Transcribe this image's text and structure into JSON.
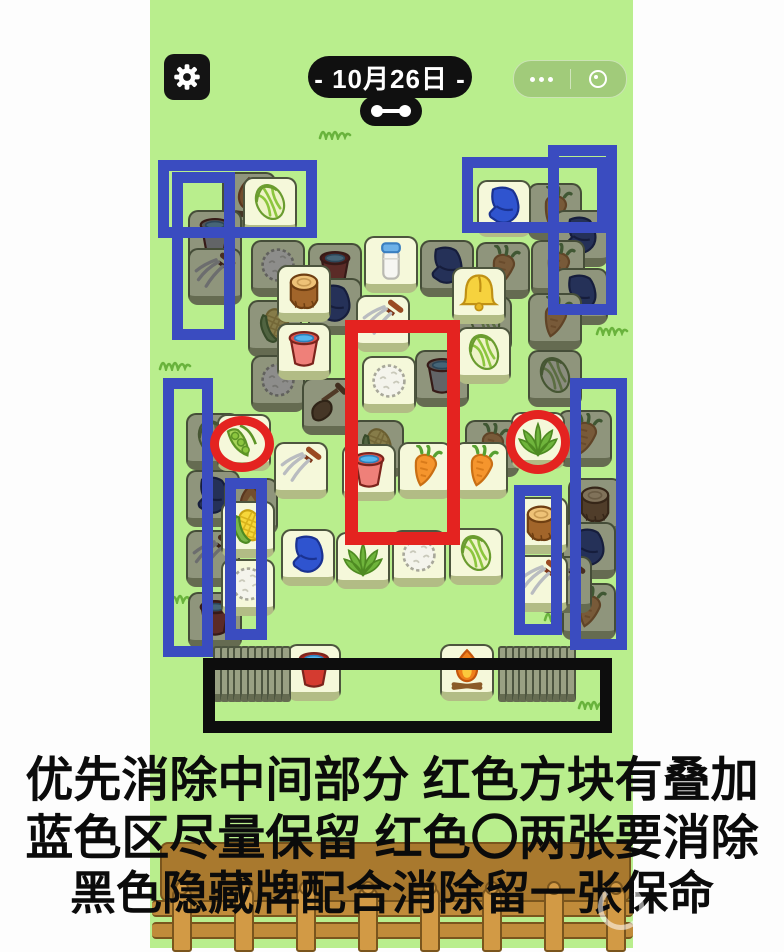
{
  "colors": {
    "background_green": "#b9ee8d",
    "margin_white": "#fdfdfd",
    "annotation_blue": "#3a4cc0",
    "annotation_red": "#e42320",
    "annotation_black": "#0d0d0d",
    "tile_face": "#f5f8da",
    "tile_face_covered": "#8f957c"
  },
  "header": {
    "date_label": "- 10月26日 -",
    "gear_icon": "gear-icon",
    "more_icon": "more-dots-icon",
    "record_icon": "record-circle-icon",
    "link_icon": "link-dumbbell-icon"
  },
  "green_column": {
    "x": 150,
    "width": 483
  },
  "board": {
    "tiles": [
      {
        "i": "fire",
        "s": "d",
        "x": 222,
        "y": 172
      },
      {
        "i": "bucket_grey",
        "s": "d",
        "x": 188,
        "y": 210
      },
      {
        "i": "fork",
        "s": "d",
        "x": 188,
        "y": 248
      },
      {
        "i": "cauliflower",
        "s": "d",
        "x": 251,
        "y": 240
      },
      {
        "i": "bucket_red",
        "s": "d",
        "x": 308,
        "y": 243
      },
      {
        "i": "glove",
        "s": "d",
        "x": 420,
        "y": 240
      },
      {
        "i": "carrot",
        "s": "d",
        "x": 476,
        "y": 242
      },
      {
        "i": "carrot",
        "s": "d",
        "x": 528,
        "y": 183
      },
      {
        "i": "glove",
        "s": "d",
        "x": 554,
        "y": 210
      },
      {
        "i": "carrot",
        "s": "d",
        "x": 531,
        "y": 240
      },
      {
        "i": "glove",
        "s": "d",
        "x": 554,
        "y": 268
      },
      {
        "i": "glove",
        "s": "d",
        "x": 308,
        "y": 278
      },
      {
        "i": "corn",
        "s": "d",
        "x": 248,
        "y": 300
      },
      {
        "i": "cabbage",
        "s": "d",
        "x": 458,
        "y": 296
      },
      {
        "i": "carrot",
        "s": "d",
        "x": 528,
        "y": 293
      },
      {
        "i": "cabbage",
        "s": "d",
        "x": 528,
        "y": 350
      },
      {
        "i": "cauliflower",
        "s": "d",
        "x": 251,
        "y": 355
      },
      {
        "i": "bucket_grey",
        "s": "d",
        "x": 415,
        "y": 350
      },
      {
        "i": "shovel",
        "s": "d",
        "x": 302,
        "y": 378
      },
      {
        "i": "corn",
        "s": "d",
        "x": 350,
        "y": 420
      },
      {
        "i": "carrot",
        "s": "d",
        "x": 465,
        "y": 420
      },
      {
        "i": "carrot",
        "s": "d",
        "x": 558,
        "y": 410
      },
      {
        "i": "cabbage",
        "s": "d",
        "x": 186,
        "y": 413
      },
      {
        "i": "glove",
        "s": "d",
        "x": 186,
        "y": 470
      },
      {
        "i": "fire",
        "s": "d",
        "x": 224,
        "y": 478
      },
      {
        "i": "fork",
        "s": "d",
        "x": 186,
        "y": 530
      },
      {
        "i": "bucket_red",
        "s": "d",
        "x": 188,
        "y": 592
      },
      {
        "i": "stump",
        "s": "d",
        "x": 568,
        "y": 478
      },
      {
        "i": "glove",
        "s": "d",
        "x": 562,
        "y": 522
      },
      {
        "i": "carrot",
        "s": "d",
        "x": 562,
        "y": 583
      },
      {
        "i": "fork",
        "s": "d",
        "x": 538,
        "y": 556
      },
      {
        "i": "cabbage",
        "s": "b",
        "x": 243,
        "y": 177
      },
      {
        "i": "glove",
        "s": "b",
        "x": 477,
        "y": 180
      },
      {
        "i": "milk",
        "s": "b",
        "x": 364,
        "y": 236
      },
      {
        "i": "bell",
        "s": "b",
        "x": 452,
        "y": 267
      },
      {
        "i": "cabbage",
        "s": "b",
        "x": 457,
        "y": 327
      },
      {
        "i": "stump",
        "s": "b",
        "x": 277,
        "y": 265
      },
      {
        "i": "bucket_pink",
        "s": "b",
        "x": 277,
        "y": 323
      },
      {
        "i": "fork",
        "s": "b",
        "x": 356,
        "y": 295
      },
      {
        "i": "cauliflower",
        "s": "b",
        "x": 362,
        "y": 356
      },
      {
        "i": "pea",
        "s": "b",
        "x": 217,
        "y": 414
      },
      {
        "i": "grass",
        "s": "b",
        "x": 511,
        "y": 412
      },
      {
        "i": "fork",
        "s": "b",
        "x": 274,
        "y": 442
      },
      {
        "i": "bucket_pink",
        "s": "b",
        "x": 342,
        "y": 444
      },
      {
        "i": "carrot",
        "s": "b",
        "x": 398,
        "y": 442
      },
      {
        "i": "carrot",
        "s": "b",
        "x": 454,
        "y": 442
      },
      {
        "i": "corn",
        "s": "b",
        "x": 221,
        "y": 501
      },
      {
        "i": "cauliflower",
        "s": "b",
        "x": 221,
        "y": 559
      },
      {
        "i": "glove",
        "s": "b",
        "x": 281,
        "y": 529
      },
      {
        "i": "grass",
        "s": "b",
        "x": 336,
        "y": 532
      },
      {
        "i": "cauliflower",
        "s": "b",
        "x": 392,
        "y": 530
      },
      {
        "i": "cabbage",
        "s": "b",
        "x": 449,
        "y": 528
      },
      {
        "i": "stump",
        "s": "b",
        "x": 514,
        "y": 497
      },
      {
        "i": "fork",
        "s": "b",
        "x": 514,
        "y": 555
      },
      {
        "i": "bucket_red",
        "s": "b",
        "x": 287,
        "y": 644
      },
      {
        "i": "fire",
        "s": "b",
        "x": 440,
        "y": 644
      }
    ],
    "left_stack": {
      "x_start": 213,
      "y": 646,
      "sliver_count": 11,
      "pitch": 6.8,
      "face_icon": "bucket_red"
    },
    "right_stack": {
      "x_start": 498,
      "y": 646,
      "sliver_count": 11,
      "pitch": 6.8,
      "face_icon": "fire"
    }
  },
  "annotations": {
    "blue_rects": [
      {
        "x": 158,
        "y": 160,
        "w": 159,
        "h": 78
      },
      {
        "x": 172,
        "y": 172,
        "w": 63,
        "h": 168
      },
      {
        "x": 163,
        "y": 378,
        "w": 50,
        "h": 279
      },
      {
        "x": 225,
        "y": 478,
        "w": 42,
        "h": 162
      },
      {
        "x": 462,
        "y": 157,
        "w": 146,
        "h": 76
      },
      {
        "x": 548,
        "y": 145,
        "w": 69,
        "h": 170
      },
      {
        "x": 570,
        "y": 378,
        "w": 57,
        "h": 272
      },
      {
        "x": 514,
        "y": 485,
        "w": 48,
        "h": 150
      }
    ],
    "red_rect": {
      "x": 345,
      "y": 320,
      "w": 115,
      "h": 225
    },
    "red_circles": [
      {
        "x": 210,
        "y": 416,
        "w": 64,
        "h": 56
      },
      {
        "x": 506,
        "y": 410,
        "w": 64,
        "h": 64
      }
    ],
    "black_rect": {
      "x": 203,
      "y": 658,
      "w": 409,
      "h": 75
    }
  },
  "tips": {
    "line1": "优先消除中间部分 红色方块有叠加",
    "line2": "蓝色区尽量保留 红色〇两张要消除",
    "line3": "黑色隐藏牌配合消除留一张保命"
  },
  "fence": {
    "post_count": 8
  },
  "doodles": [
    {
      "x": 318,
      "y": 124
    },
    {
      "x": 595,
      "y": 320
    },
    {
      "x": 158,
      "y": 355
    },
    {
      "x": 593,
      "y": 486
    },
    {
      "x": 163,
      "y": 588
    },
    {
      "x": 543,
      "y": 606
    },
    {
      "x": 577,
      "y": 694
    }
  ]
}
